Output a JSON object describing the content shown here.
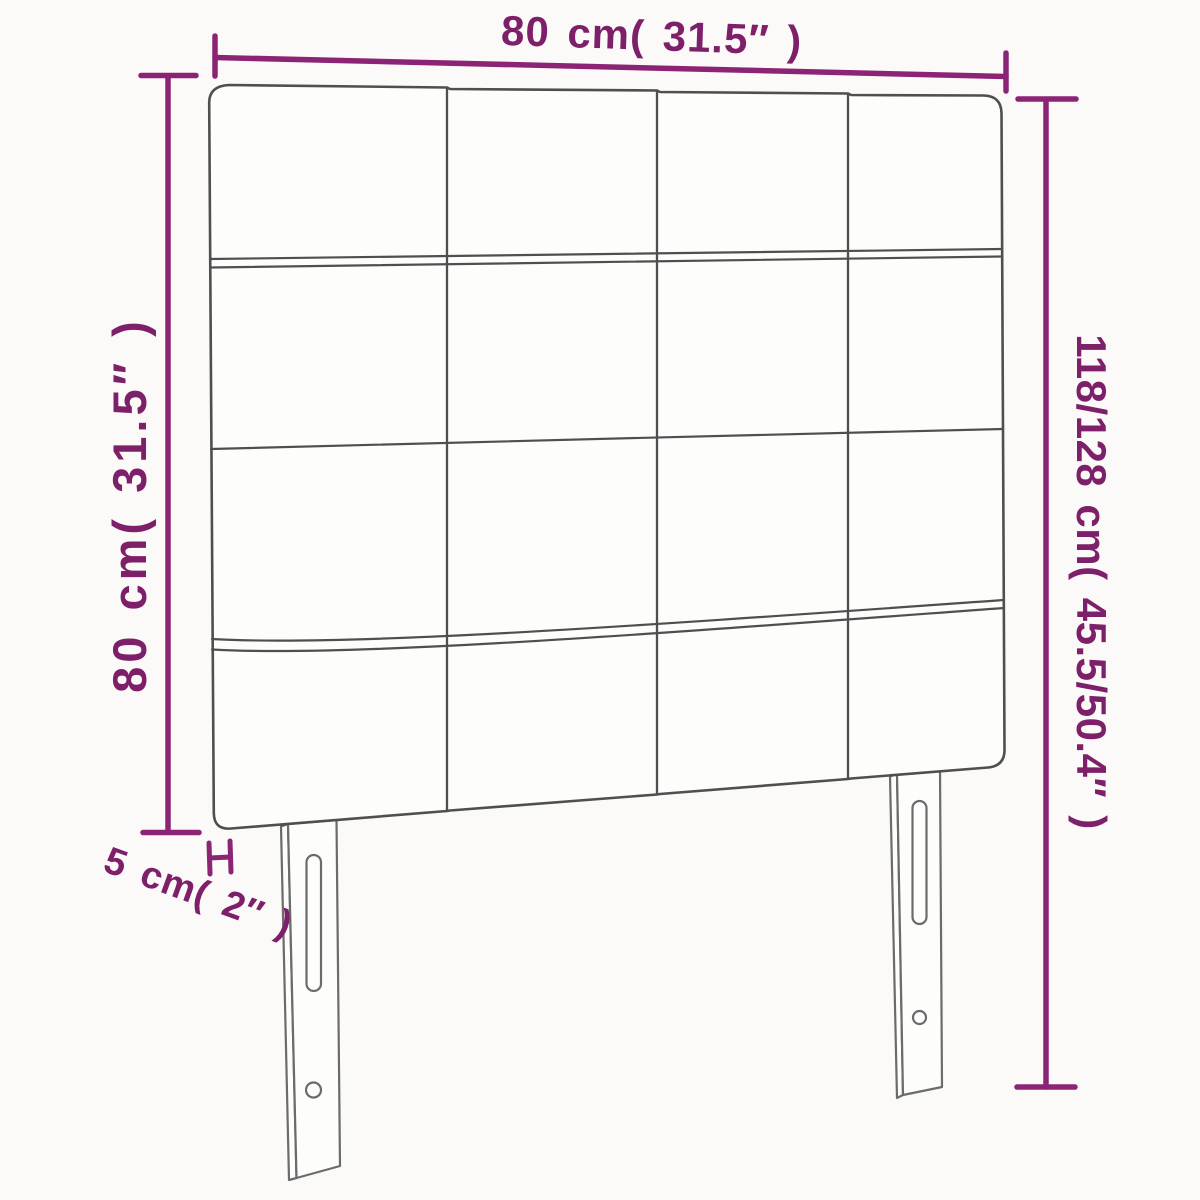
{
  "diagram": {
    "kind": "product dimension diagram",
    "subject": "upholstered headboard with 4x4 tufted square grid and two slotted mounting legs"
  },
  "labels": {
    "top_width": "80 cm( 31.5″ )",
    "left_height": "80 cm( 31.5″ )",
    "right_height": "118/128 cm( 45.5/50.4″ )",
    "leg_depth": "5 cm( 2″ )"
  },
  "colors": {
    "dimension_text": "#7e1f69",
    "dimension_line": "#8c2476",
    "drawing_outline": "#4f4f4f",
    "background": "#fbfaf9"
  }
}
